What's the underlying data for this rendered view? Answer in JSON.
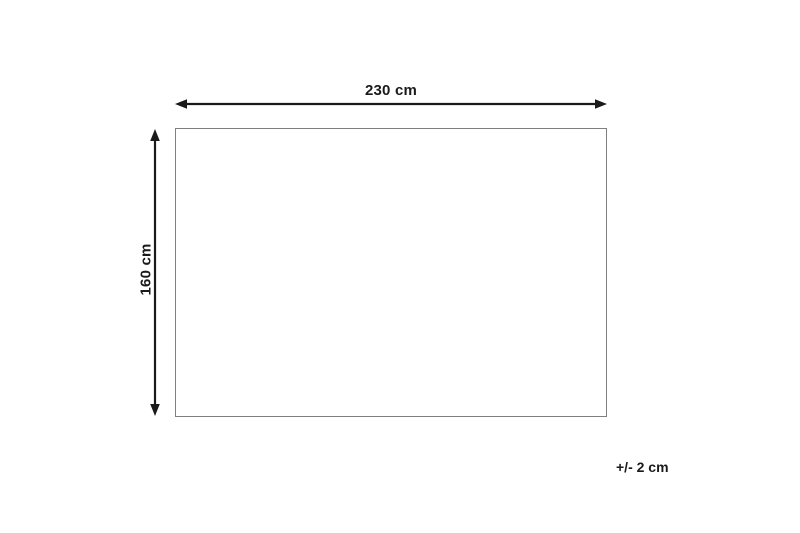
{
  "diagram": {
    "width_label": "230 cm",
    "height_label": "160 cm",
    "tolerance_label": "+/- 2 cm"
  },
  "colors": {
    "background": "#ffffff",
    "arrow": "#1a1a1a",
    "text": "#1a1a1a",
    "rect_border": "#7f7f7f"
  }
}
